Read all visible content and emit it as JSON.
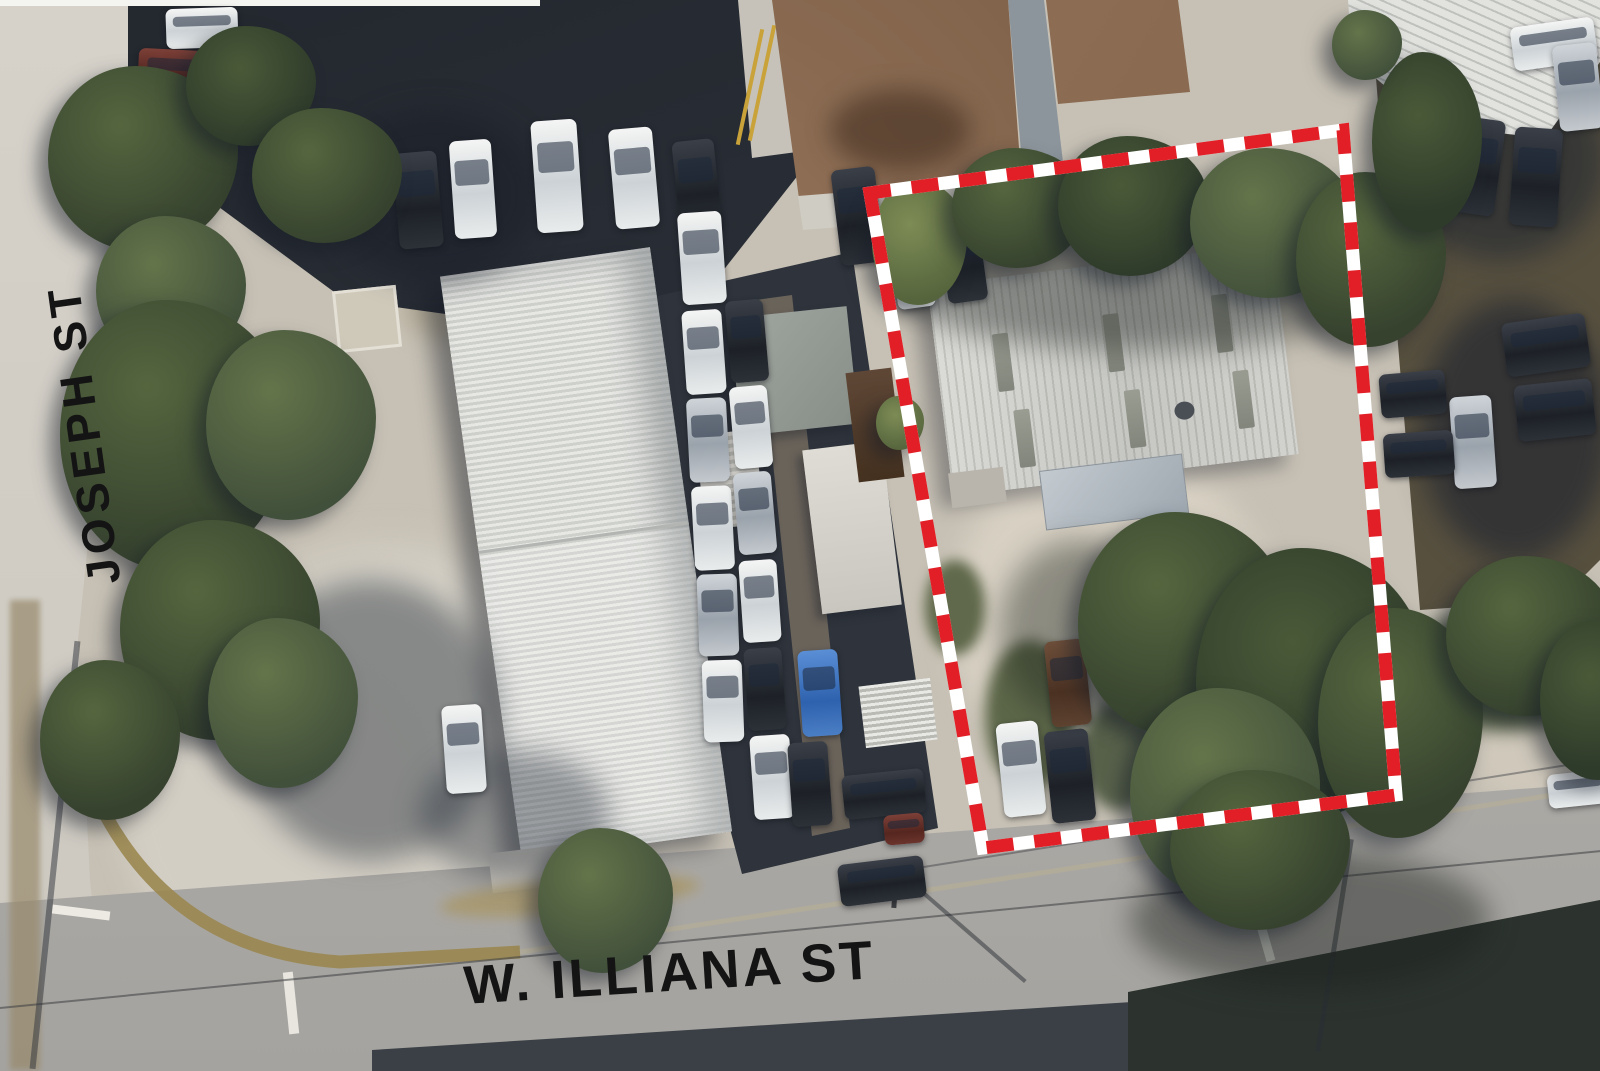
{
  "map": {
    "street_labels": {
      "left": "JOSEPH ST",
      "bottom": "W. ILLIANA ST"
    },
    "parcel_boundary": {
      "color": "#e21f26",
      "gap_color": "#ffffff",
      "style": "dashed",
      "points": "870,193 1343,130 1396,795 983,848"
    }
  }
}
